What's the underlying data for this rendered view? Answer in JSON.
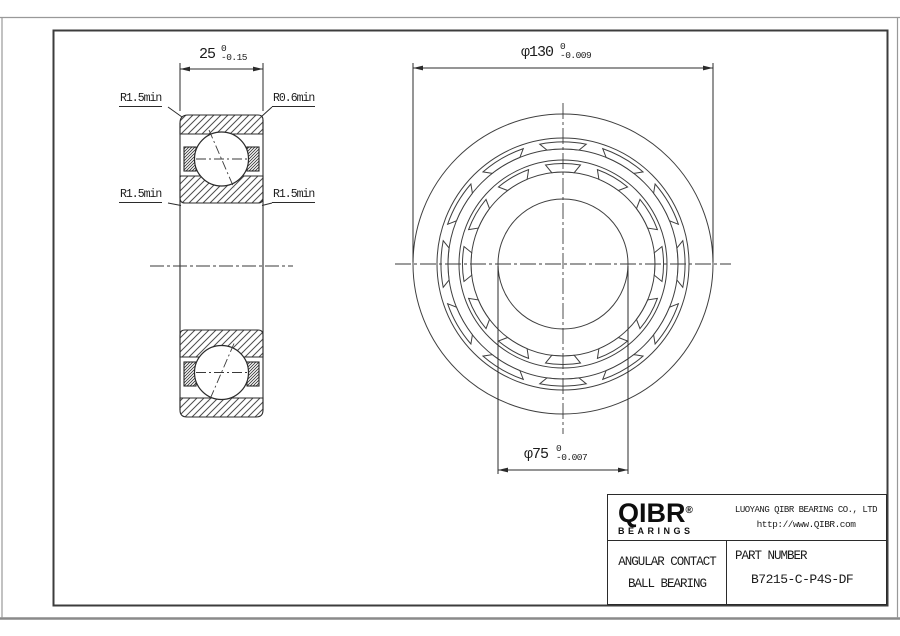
{
  "section_view": {
    "dim_width": {
      "value": "25",
      "tol_upper": "0",
      "tol_lower": "-0.15"
    },
    "label_top_left": "R1.5min",
    "label_top_right": "R0.6min",
    "label_mid_left": "R1.5min",
    "label_mid_right": "R1.5min"
  },
  "front_view": {
    "dim_outer": {
      "value": "φ130",
      "tol_upper": "0",
      "tol_lower": "-0.009"
    },
    "dim_bore": {
      "value": "φ75",
      "tol_upper": "0",
      "tol_lower": "-0.007"
    }
  },
  "title_block": {
    "logo_text": "QIBR",
    "logo_reg": "®",
    "logo_sub": "BEARINGS",
    "company": "LUOYANG QIBR BEARING CO., LTD",
    "website": "http://www.QIBR.com",
    "product_line1": "ANGULAR CONTACT",
    "product_line2": "BALL BEARING",
    "part_label": "PART NUMBER",
    "part_number": "B7215-C-P4S-DF"
  },
  "colors": {
    "line": "#3a3a3a",
    "dark": "#1c1c1c",
    "page_border": "#999999"
  }
}
